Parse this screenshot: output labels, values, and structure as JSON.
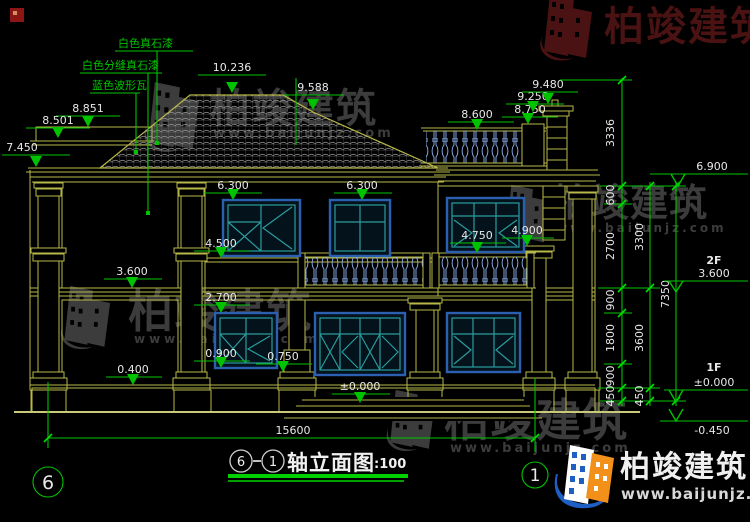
{
  "materials": {
    "m1": "白色真石漆",
    "m2": "白色分缝真石漆",
    "m3": "蓝色波形瓦"
  },
  "levels": {
    "l10236": "10.236",
    "l9588": "9.588",
    "l8851": "8.851",
    "l8501": "8.501",
    "l7450": "7.450",
    "l8600": "8.600",
    "l8750": "8.750",
    "l9250": "9.250",
    "l9480": "9.480",
    "l6300a": "6.300",
    "l6300b": "6.300",
    "l4500": "4.500",
    "l4750": "4.750",
    "l4900": "4.900",
    "l3600": "3.600",
    "l2700": "2.700",
    "l0900": "0.900",
    "l0750": "0.750",
    "l0400": "0.400",
    "l0000": "±0.000"
  },
  "right": {
    "eave": "6.900",
    "f2": "2F",
    "f2v": "3.600",
    "f1": "1F",
    "f1v": "±0.000",
    "below": "-0.450"
  },
  "dims": {
    "v3336": "3336",
    "v600": "600",
    "v2700": "2700",
    "v900a": "900",
    "v1800": "1800",
    "v900b": "900",
    "v450a": "450",
    "v3300": "3300",
    "v3600": "3600",
    "v450b": "450",
    "v7350": "7350",
    "total": "15600"
  },
  "axes": {
    "left": "6",
    "right": "1"
  },
  "title": {
    "from": "6",
    "to": "1",
    "name": "轴立面图",
    "scale": ":100"
  },
  "brand": {
    "name": "柏竣建筑",
    "url": "www.baijunjz.com"
  },
  "colors": {
    "cad_green": "#00c300",
    "cad_yellow": "#b8b84a",
    "text_white": "#e8e8e8",
    "window_teal": "#2a9d9d",
    "window_blue": "#2b5fb0",
    "baluster_blue": "#8fb4f2",
    "watermark_gray": "#3c3c3c",
    "watermark_red": "#4a1212",
    "logo_blue": "#1d5fc2",
    "logo_orange": "#f39019"
  }
}
